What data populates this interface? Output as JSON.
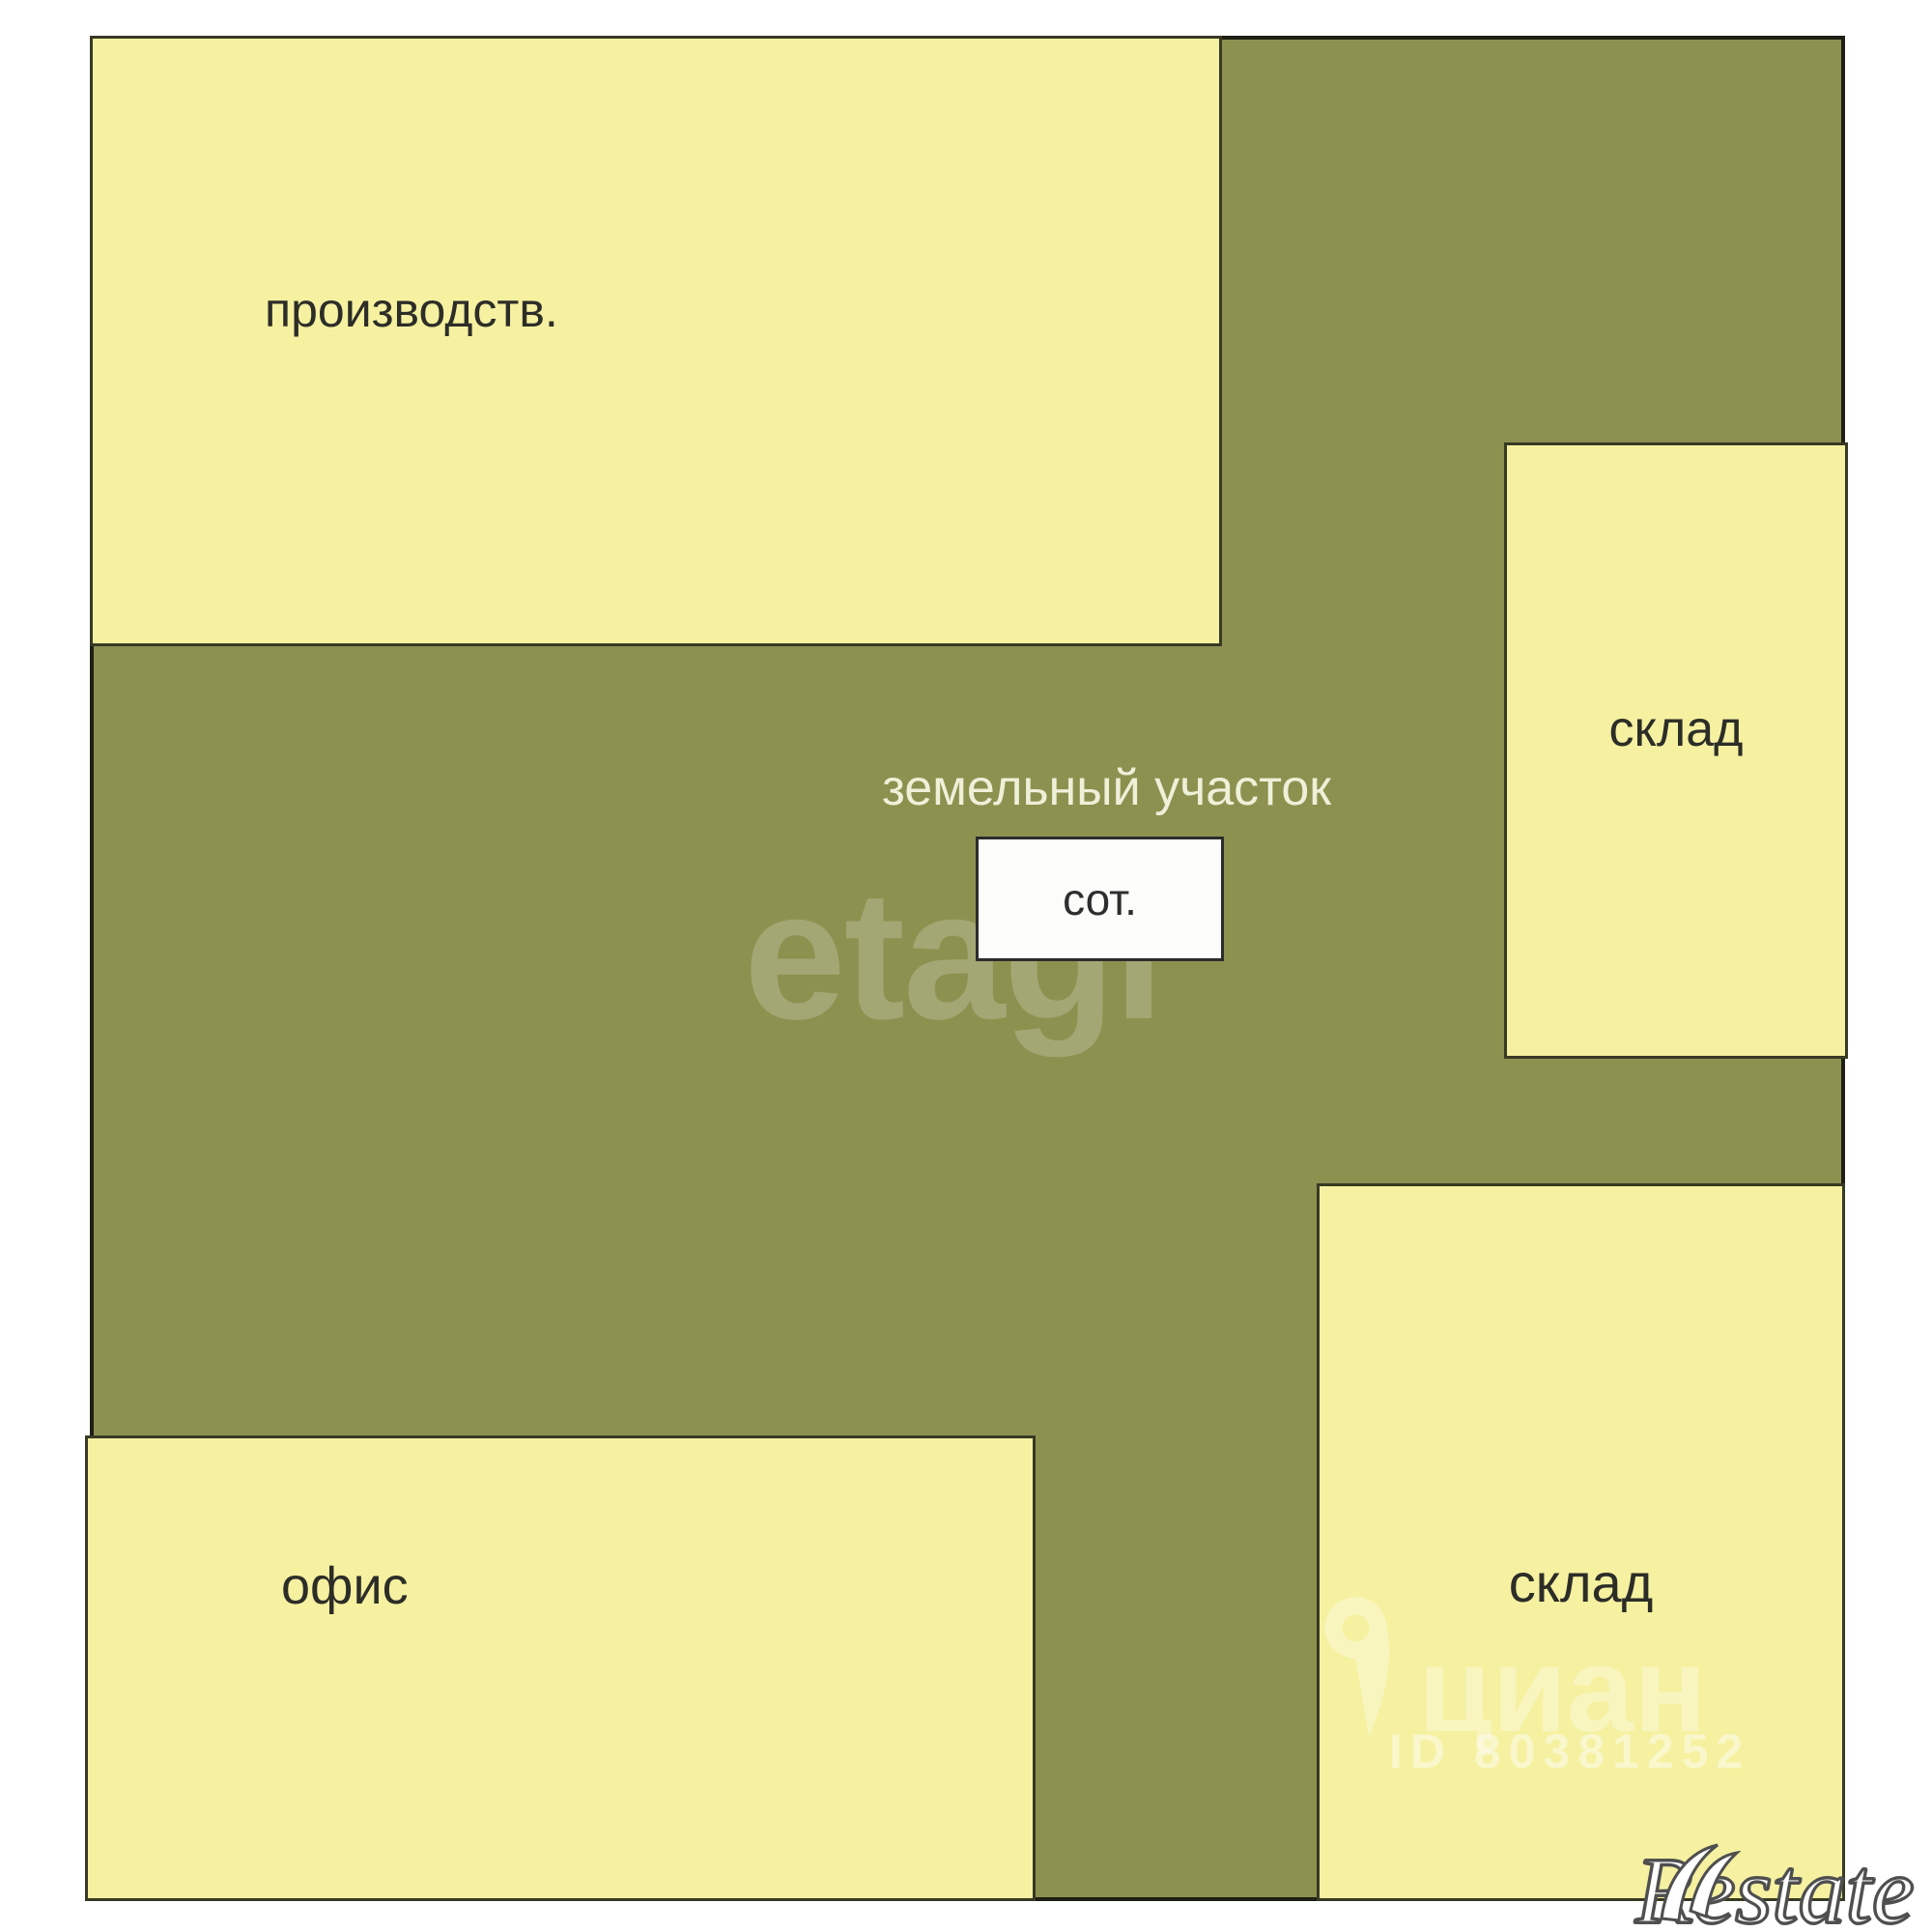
{
  "plan": {
    "land_plot": {
      "label": "земельный участок",
      "area_box_label": "сот."
    },
    "buildings": [
      {
        "name": "production",
        "label": "производств."
      },
      {
        "name": "warehouse-upper",
        "label": "склад"
      },
      {
        "name": "warehouse-lower",
        "label": "склад"
      },
      {
        "name": "office",
        "label": "офис"
      }
    ],
    "watermarks": {
      "etagi": "etagi",
      "cian": "циан",
      "cian_id": "ID 80381252",
      "restate": "Restate"
    },
    "colors": {
      "building_fill": "#f5f1a0",
      "land_fill": "#8d9150",
      "outer_border": "#1e1f15",
      "block_border": "#383a24",
      "label_color": "#2d2d28",
      "land_label_color": "#eef0d8",
      "area_box_fill": "#fcfcfa"
    }
  }
}
